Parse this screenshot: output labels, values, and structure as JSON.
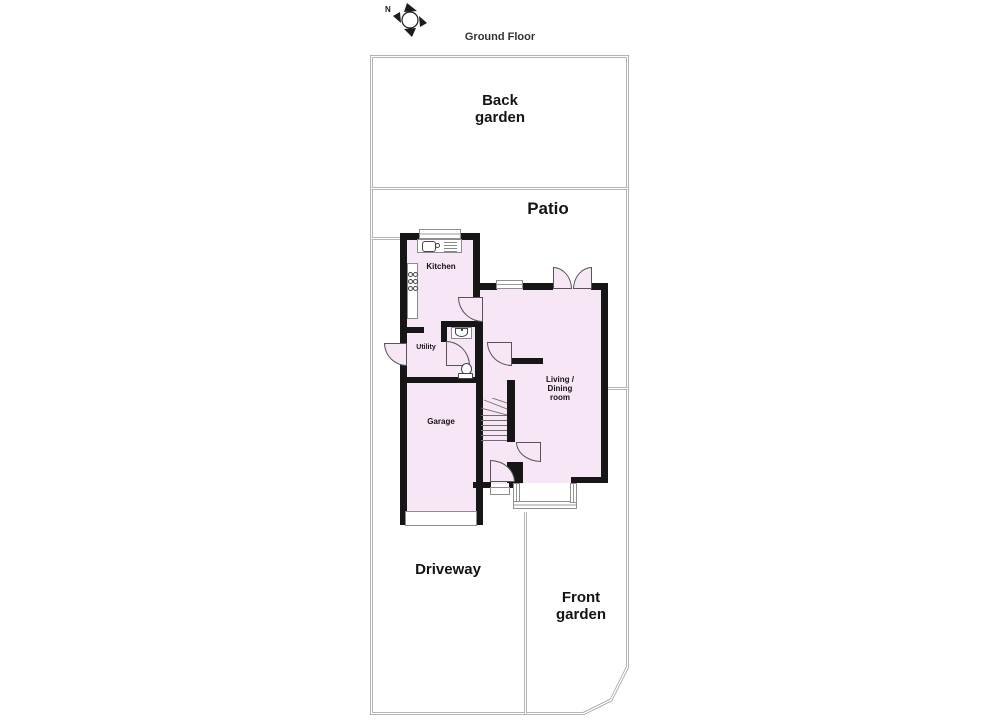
{
  "title": "Ground Floor",
  "compass": {
    "north_label": "N"
  },
  "areas": {
    "back_garden": "Back garden",
    "patio": "Patio",
    "driveway": "Driveway",
    "front_garden": "Front garden"
  },
  "rooms": {
    "kitchen": "Kitchen",
    "utility": "Utility",
    "garage": "Garage",
    "living_dining": "Living / Dining room"
  },
  "colors": {
    "room_fill": "#f7e6f6",
    "wall_color": "#161616",
    "boundary_color": "#9a9a9a",
    "door_outline": "#555555"
  }
}
